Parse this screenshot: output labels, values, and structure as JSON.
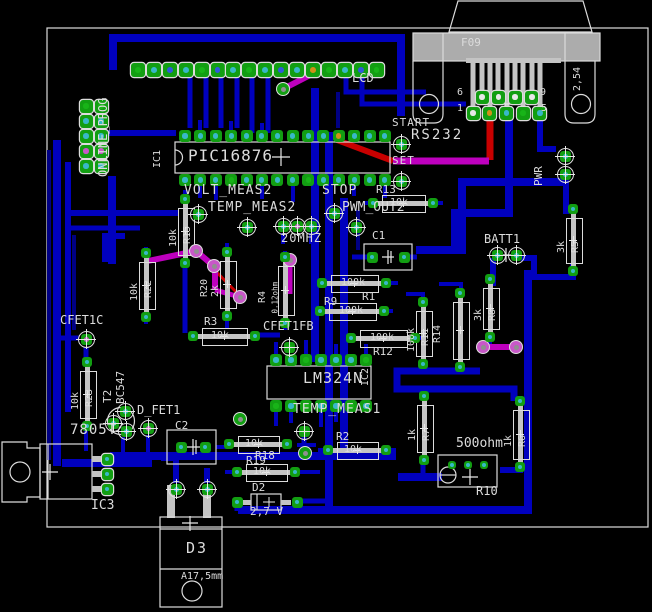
{
  "app": {
    "view_title": "PCB board layout"
  },
  "palette": {
    "trace_blue": "#0000BE",
    "trace_blue_dark": "#000084",
    "trace_magenta": "#BE00BE",
    "trace_red": "#C80000",
    "silkscreen": "#DCDCDC",
    "connector_gray": "#ACACAC",
    "pad_green": "#129E12",
    "center_green": "#18B418",
    "center_cyan": "#38B8C8",
    "center_blue": "#3058DC",
    "center_orange": "#D09018",
    "center_magenta": "#C858C8",
    "center_white": "#E8E8E8",
    "board_bg": "#000000"
  },
  "board": {
    "outline_px": [
      47,
      28,
      648,
      527
    ]
  },
  "connector": {
    "ref": "F09",
    "interface_label": "RS232",
    "pitch": "2,54",
    "pin_numbers": [
      "6",
      "9",
      "1",
      "5"
    ]
  },
  "headers": {
    "lcd": {
      "label": "LCD",
      "pins": 16
    },
    "online_prog": {
      "label": "ONLINE_PROG",
      "pins": 10
    }
  },
  "ics": [
    {
      "ref": "IC1",
      "part": "PIC16876"
    },
    {
      "ref": "IC2",
      "part": "LM324N"
    },
    {
      "ref": "IC3",
      "part": "7805T"
    }
  ],
  "signals": [
    "START",
    "SET",
    "STOP",
    "PWR",
    "VOLT_MEAS2",
    "TEMP_MEAS2",
    "PWM_OUT2",
    "TEMP_MEAS1",
    "CFET1C",
    "CFET1FB",
    "D_FET1",
    "BATT1",
    "20MHZ"
  ],
  "parts_misc": [
    {
      "ref": "T2",
      "part": "BC547"
    },
    {
      "ref": "D2",
      "value": "2,7 V"
    },
    {
      "ref": "D3",
      "note": "A17,5mm"
    },
    {
      "ref": "R10",
      "value": "500ohm"
    },
    {
      "ref": "C1"
    },
    {
      "ref": "C2"
    }
  ],
  "resistors": [
    {
      "ref": "R15",
      "value": "10k",
      "orient": "v",
      "cx": 185,
      "cy": 231,
      "bl": 46,
      "side": "r"
    },
    {
      "ref": "R22",
      "value": "10k",
      "orient": "v",
      "cx": 146,
      "cy": 285,
      "bl": 46,
      "side": "r"
    },
    {
      "ref": "R20",
      "value": "2k",
      "orient": "v",
      "cx": 227,
      "cy": 284,
      "bl": 46,
      "side": "l"
    },
    {
      "ref": "R4",
      "value": "0.12ohm",
      "orient": "v",
      "cx": 285,
      "cy": 290,
      "bl": 48,
      "side": "l"
    },
    {
      "ref": "R23",
      "value": "10k",
      "orient": "v",
      "cx": 87,
      "cy": 394,
      "bl": 46,
      "side": "r"
    },
    {
      "ref": "R11",
      "value": "100k",
      "orient": "v",
      "cx": 423,
      "cy": 333,
      "bl": 44,
      "side": "r"
    },
    {
      "ref": "R14",
      "value": "",
      "orient": "v",
      "cx": 460,
      "cy": 330,
      "bl": 56,
      "side": "l"
    },
    {
      "ref": "R8",
      "value": "3k",
      "orient": "v",
      "cx": 490,
      "cy": 308,
      "bl": 40,
      "side": "r"
    },
    {
      "ref": "R5",
      "value": "3k",
      "orient": "v",
      "cx": 573,
      "cy": 240,
      "bl": 44,
      "side": "r"
    },
    {
      "ref": "R7",
      "value": "1k",
      "orient": "v",
      "cx": 424,
      "cy": 428,
      "bl": 46,
      "side": "r"
    },
    {
      "ref": "R6",
      "value": "1k",
      "orient": "v",
      "cx": 520,
      "cy": 434,
      "bl": 48,
      "side": "r"
    },
    {
      "ref": "R3",
      "value": "10k",
      "orient": "h",
      "cx": 224,
      "cy": 336,
      "bw": 44,
      "ref_pos": [
        204,
        316
      ]
    },
    {
      "ref": "R1",
      "value": "100k",
      "orient": "h",
      "cx": 354,
      "cy": 283,
      "bw": 46,
      "ref_pos": [
        362,
        291
      ]
    },
    {
      "ref": "R9",
      "value": "100k",
      "orient": "h",
      "cx": 352,
      "cy": 311,
      "bw": 46,
      "ref_pos": [
        324,
        296
      ]
    },
    {
      "ref": "R12",
      "value": "100k",
      "orient": "h",
      "cx": 383,
      "cy": 338,
      "bw": 46,
      "ref_pos": [
        373,
        346
      ]
    },
    {
      "ref": "R13",
      "value": "10k",
      "orient": "h",
      "cx": 403,
      "cy": 203,
      "bw": 42,
      "ref_pos": [
        376,
        184
      ]
    },
    {
      "ref": "R2",
      "value": "10k",
      "orient": "h",
      "cx": 357,
      "cy": 450,
      "bw": 40,
      "ref_pos": [
        336,
        431
      ]
    },
    {
      "ref": "R18",
      "value": "10k",
      "orient": "h",
      "cx": 258,
      "cy": 444,
      "bw": 40,
      "ref_pos": [
        255,
        450
      ]
    },
    {
      "ref": "R19",
      "value": "10k",
      "orient": "h",
      "cx": 266,
      "cy": 472,
      "bw": 40,
      "ref_pos": [
        246,
        455
      ]
    }
  ],
  "labels": [
    {
      "t": "LCD",
      "x": 352,
      "y": 72,
      "s": 12
    },
    {
      "t": "ONLINE_PROG",
      "x": 109,
      "y": 177,
      "s": 12,
      "rot": 1
    },
    {
      "t": "F09",
      "x": 461,
      "y": 37,
      "s": 11
    },
    {
      "t": "2,54",
      "x": 583,
      "y": 91,
      "s": 10,
      "rot": 1
    },
    {
      "t": "6",
      "x": 457,
      "y": 88,
      "s": 10
    },
    {
      "t": "9",
      "x": 540,
      "y": 88,
      "s": 10
    },
    {
      "t": "1",
      "x": 457,
      "y": 104,
      "s": 10
    },
    {
      "t": "5",
      "x": 541,
      "y": 104,
      "s": 10
    },
    {
      "t": "RS232",
      "x": 411,
      "y": 128,
      "s": 14,
      "ls": 2
    },
    {
      "t": "START",
      "x": 392,
      "y": 117,
      "s": 11,
      "ls": 1
    },
    {
      "t": "SET",
      "x": 392,
      "y": 155,
      "s": 11,
      "ls": 1
    },
    {
      "t": "PWR",
      "x": 544,
      "y": 186,
      "s": 11,
      "rot": 1
    },
    {
      "t": "PIC16876",
      "x": 188,
      "y": 148,
      "s": 16,
      "ls": 1
    },
    {
      "t": "IC1",
      "x": 163,
      "y": 168,
      "s": 10,
      "rot": 1
    },
    {
      "t": "VOLT_MEAS2",
      "x": 184,
      "y": 184,
      "s": 13,
      "ls": 1
    },
    {
      "t": "TEMP_MEAS2",
      "x": 208,
      "y": 201,
      "s": 13,
      "ls": 1
    },
    {
      "t": "STOP",
      "x": 322,
      "y": 184,
      "s": 13,
      "ls": 1
    },
    {
      "t": "PWM_OUT2",
      "x": 342,
      "y": 201,
      "s": 13,
      "ls": 0
    },
    {
      "t": "20MHZ",
      "x": 281,
      "y": 232,
      "s": 12,
      "ls": 1
    },
    {
      "t": "C1",
      "x": 372,
      "y": 230,
      "s": 11
    },
    {
      "t": "BATT1",
      "x": 484,
      "y": 233,
      "s": 12
    },
    {
      "t": "CFET1C",
      "x": 60,
      "y": 314,
      "s": 12
    },
    {
      "t": "CFET1FB",
      "x": 263,
      "y": 320,
      "s": 12
    },
    {
      "t": "T2",
      "x": 113,
      "y": 403,
      "s": 11,
      "rot": 1
    },
    {
      "t": "BC547",
      "x": 126,
      "y": 404,
      "s": 11,
      "rot": 1
    },
    {
      "t": "D_FET1",
      "x": 137,
      "y": 404,
      "s": 12
    },
    {
      "t": "7805T",
      "x": 70,
      "y": 423,
      "s": 14,
      "ls": 1
    },
    {
      "t": "IC3",
      "x": 91,
      "y": 499,
      "s": 13
    },
    {
      "t": "C2",
      "x": 175,
      "y": 420,
      "s": 11
    },
    {
      "t": "LM324N",
      "x": 303,
      "y": 371,
      "s": 15,
      "ls": 1
    },
    {
      "t": "IC2",
      "x": 371,
      "y": 386,
      "s": 10,
      "rot": 1
    },
    {
      "t": "TEMP_MEAS1",
      "x": 293,
      "y": 403,
      "s": 13,
      "ls": 1
    },
    {
      "t": "D2",
      "x": 252,
      "y": 482,
      "s": 11
    },
    {
      "t": "2,7 V",
      "x": 250,
      "y": 506,
      "s": 11
    },
    {
      "t": "D3",
      "x": 186,
      "y": 541,
      "s": 15,
      "ls": 2
    },
    {
      "t": "A17,5mm",
      "x": 181,
      "y": 572,
      "s": 10
    },
    {
      "t": "500ohm",
      "x": 456,
      "y": 437,
      "s": 13
    },
    {
      "t": "R10",
      "x": 476,
      "y": 485,
      "s": 12
    }
  ],
  "test_points": [
    {
      "id": "START",
      "x": 401,
      "y": 144,
      "c": "cyan"
    },
    {
      "id": "SET",
      "x": 401,
      "y": 181,
      "c": "cyan"
    },
    {
      "id": "VOLT_MEAS2",
      "x": 198,
      "y": 214,
      "c": "cyan"
    },
    {
      "id": "TEMP_MEAS2",
      "x": 247,
      "y": 227,
      "c": "cyan"
    },
    {
      "id": "STOP",
      "x": 334,
      "y": 213,
      "c": "cyan"
    },
    {
      "id": "PWM_OUT2",
      "x": 356,
      "y": 227,
      "c": "cyan"
    },
    {
      "id": "XTAL-1",
      "x": 283,
      "y": 226,
      "c": "cyan"
    },
    {
      "id": "XTAL-2",
      "x": 297,
      "y": 226,
      "c": "magenta"
    },
    {
      "id": "XTAL-3",
      "x": 311,
      "y": 226,
      "c": "cyan"
    },
    {
      "id": "TEMP_MEAS1",
      "x": 304,
      "y": 431,
      "c": "green"
    },
    {
      "id": "CFET1C",
      "x": 86,
      "y": 339,
      "c": "magenta"
    },
    {
      "id": "CFET1FB",
      "x": 289,
      "y": 347,
      "c": "green"
    },
    {
      "id": "D_FET1",
      "x": 148,
      "y": 428,
      "c": "magenta"
    },
    {
      "id": "BATT1-1",
      "x": 497,
      "y": 255,
      "c": "cyan"
    },
    {
      "id": "BATT1-2",
      "x": 516,
      "y": 255,
      "c": "cyan"
    },
    {
      "id": "PWR-1",
      "x": 565,
      "y": 156,
      "c": "cyan"
    },
    {
      "id": "PWR-2",
      "x": 565,
      "y": 174,
      "c": "cyan"
    },
    {
      "id": "T2-1",
      "x": 125,
      "y": 411,
      "c": "cyan"
    },
    {
      "id": "T2-2",
      "x": 113,
      "y": 423,
      "c": "cyan"
    },
    {
      "id": "T2-3",
      "x": 126,
      "y": 431,
      "c": "cyan"
    },
    {
      "id": "D3-1",
      "x": 176,
      "y": 489,
      "c": "cyan"
    },
    {
      "id": "D3-2",
      "x": 207,
      "y": 489,
      "c": "cyan"
    }
  ],
  "vias": [
    {
      "x": 283,
      "y": 89,
      "ring": "green"
    },
    {
      "x": 196,
      "y": 251,
      "ring": "magenta"
    },
    {
      "x": 214,
      "y": 266,
      "ring": "magenta"
    },
    {
      "x": 240,
      "y": 297,
      "ring": "magenta"
    },
    {
      "x": 290,
      "y": 260,
      "ring": "magenta"
    },
    {
      "x": 483,
      "y": 347,
      "ring": "magenta"
    },
    {
      "x": 516,
      "y": 347,
      "ring": "magenta"
    },
    {
      "x": 240,
      "y": 419,
      "ring": "green"
    },
    {
      "x": 305,
      "y": 453,
      "ring": "green"
    }
  ],
  "pad_rows": [
    {
      "id": "lcd-header",
      "x": 138,
      "y": 70,
      "dx": 15.9,
      "dy": 0,
      "n": 16,
      "size": 14,
      "ring": true,
      "colors": [
        "green",
        "cyan",
        "blue",
        "cyan",
        "green",
        "blue",
        "cyan",
        "green",
        "cyan",
        "blue",
        "cyan",
        "orange",
        "green",
        "cyan",
        "blue",
        "green"
      ]
    },
    {
      "id": "pic-top",
      "x": 185,
      "y": 136,
      "dx": 15.38,
      "dy": 0,
      "n": 14,
      "size": 12,
      "ring": false,
      "colors": [
        "cyan",
        "cyan",
        "cyan",
        "cyan",
        "cyan",
        "cyan",
        "cyan",
        "cyan",
        "cyan",
        "cyan",
        "orange",
        "cyan",
        "cyan",
        "cyan"
      ]
    },
    {
      "id": "pic-bottom",
      "x": 185,
      "y": 180,
      "dx": 15.38,
      "dy": 0,
      "n": 14,
      "size": 12,
      "ring": false,
      "colors": [
        "cyan",
        "cyan",
        "cyan",
        "green",
        "cyan",
        "cyan",
        "cyan",
        "cyan",
        "green",
        "cyan",
        "cyan",
        "cyan",
        "cyan",
        "cyan"
      ]
    },
    {
      "id": "lm324-top",
      "x": 276,
      "y": 360,
      "dx": 15,
      "dy": 0,
      "n": 7,
      "size": 12,
      "ring": false,
      "colors": [
        "cyan",
        "cyan",
        "green",
        "cyan",
        "cyan",
        "cyan",
        "green"
      ]
    },
    {
      "id": "lm324-bottom",
      "x": 276,
      "y": 406,
      "dx": 15,
      "dy": 0,
      "n": 7,
      "size": 12,
      "ring": false,
      "colors": [
        "green",
        "cyan",
        "green",
        "cyan",
        "cyan",
        "green",
        "cyan"
      ]
    },
    {
      "id": "online-prog-col1",
      "x": 86,
      "y": 106,
      "dx": 0,
      "dy": 15,
      "n": 5,
      "size": 13,
      "ring": true,
      "colors": [
        "green",
        "cyan",
        "cyan",
        "magenta",
        "cyan"
      ]
    },
    {
      "id": "online-prog-col2",
      "x": 101,
      "y": 106,
      "dx": 0,
      "dy": 15,
      "n": 5,
      "size": 13,
      "ring": true,
      "colors": [
        "green",
        "cyan",
        "cyan",
        "magenta",
        "cyan"
      ]
    },
    {
      "id": "db9-top-row",
      "x": 482,
      "y": 97,
      "dx": 16.6,
      "dy": 0,
      "n": 4,
      "size": 13,
      "ring": true,
      "colors": [
        "white",
        "white",
        "white",
        "white"
      ]
    },
    {
      "id": "db9-bottom-row",
      "x": 473,
      "y": 113,
      "dx": 16.7,
      "dy": 0,
      "n": 5,
      "size": 13,
      "ring": true,
      "colors": [
        "white",
        "orange",
        "cyan",
        "green",
        "cyan"
      ]
    },
    {
      "id": "c1-pads",
      "x": 372,
      "y": 257,
      "dx": 32,
      "dy": 0,
      "n": 2,
      "size": 11,
      "ring": false,
      "colors": [
        "cyan",
        "cyan"
      ]
    },
    {
      "id": "c2-pads",
      "x": 181,
      "y": 447,
      "dx": 24,
      "dy": 0,
      "n": 2,
      "size": 11,
      "ring": false,
      "colors": [
        "cyan",
        "cyan"
      ]
    },
    {
      "id": "r10-pads",
      "x": 452,
      "y": 465,
      "dx": 16,
      "dy": 0,
      "n": 3,
      "size": 8,
      "ring": false,
      "colors": [
        "cyan",
        "cyan",
        "cyan"
      ]
    },
    {
      "id": "ic3-pads",
      "x": 107,
      "y": 459,
      "dx": 0,
      "dy": 15,
      "n": 3,
      "size": 11,
      "ring": true,
      "colors": [
        "cyan",
        "cyan",
        "cyan"
      ]
    },
    {
      "id": "d2-pads",
      "x": 237,
      "y": 502,
      "dx": 60,
      "dy": 0,
      "n": 2,
      "size": 11,
      "ring": false,
      "colors": [
        "cyan",
        "cyan"
      ]
    }
  ]
}
